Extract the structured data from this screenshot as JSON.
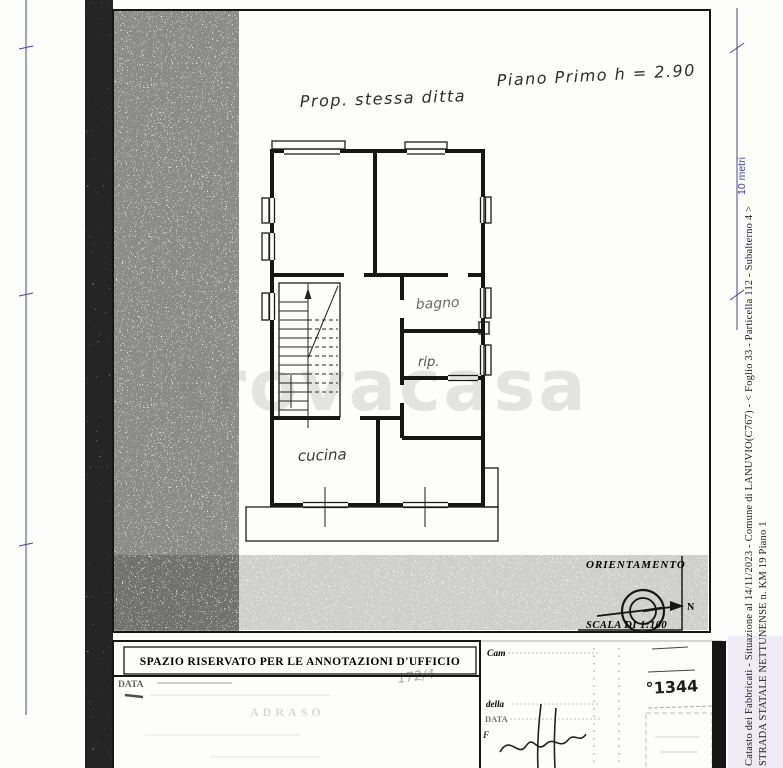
{
  "plan": {
    "prop_note": "Prop. stessa ditta",
    "floor_note": "Piano Primo h = 2.90",
    "room_labels": {
      "bathroom": "bagno",
      "closet": "rip.",
      "kitchen": "cucina"
    },
    "watermark": "trovacasa"
  },
  "orientation": {
    "title": "ORIENTAMENTO",
    "north_label": "N",
    "scale_label": "SCALA DI 1:100"
  },
  "ruler": {
    "label": "10 metri",
    "color": "#4343a9"
  },
  "annotations_box": {
    "header": "SPAZIO RISERVATO PER LE ANNOTAZIONI D'UFFICIO",
    "date_label": "DATA",
    "handwritten_ref": "172/4",
    "faint_stamp": "ADRASO"
  },
  "office_form": {
    "row1_label": "Cam",
    "row2_label": "della",
    "row3_label": "DATA",
    "row4_label": "F",
    "protocol_number": "°1344"
  },
  "sidebar": {
    "line1": "Catasto dei Fabbricati - Situazione al 14/11/2023 - Comune di LANUVIO(C767) - < Foglio 33 - Particella 112 - Subalterno 4 >",
    "line2": "STRADA STATALE NETTUNENSE n. KM 19 Piano 1"
  }
}
